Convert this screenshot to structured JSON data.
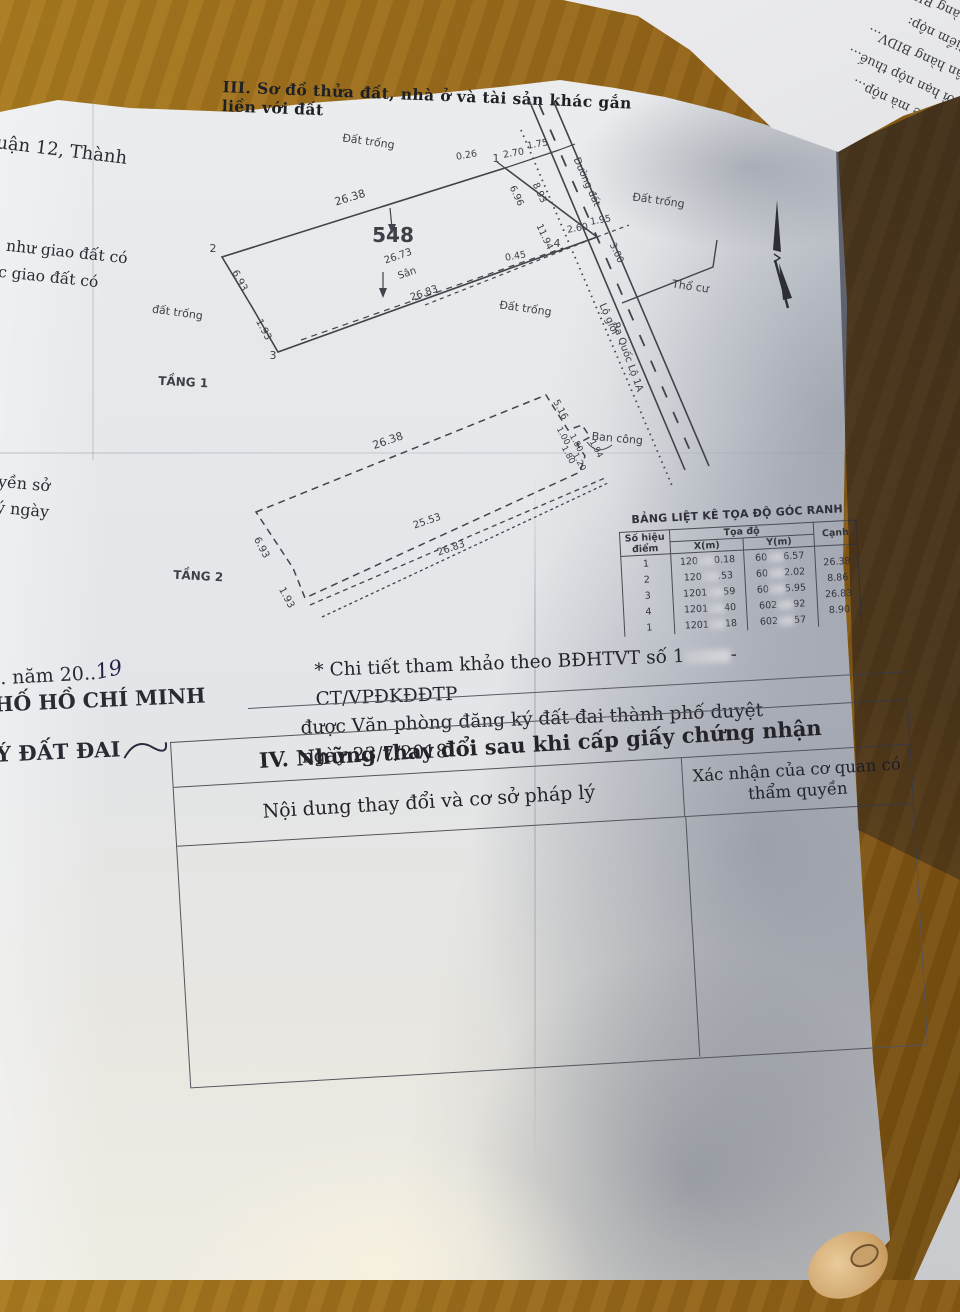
{
  "colors": {
    "wood": "#94661a",
    "paper": "#e6e8ea",
    "ink": "#232329",
    "diagram_ink": "#3e3f47",
    "shadow": "#5a6275"
  },
  "header": {
    "section_title": "III. Sơ đồ thửa đất, nhà ở và tài sản khác gắn liền với đất"
  },
  "left_margin": {
    "f1": "uận 12, Thành",
    "f2": "như giao đất có",
    "f3": "c giao đất có",
    "f4": "yền sở",
    "f5": "ý ngày",
    "f6a": ". năm 20..",
    "f6_handwritten": "19",
    "f7": "HỐ HỒ CHÍ MINH",
    "f8": "Ý ĐẤT ĐAI"
  },
  "diagram": {
    "parcel_number": "548",
    "labels": [
      {
        "t": "Đất trống",
        "x": 243,
        "y": 45,
        "r": 8,
        "s": 11
      },
      {
        "t": "Đất trống",
        "x": 533,
        "y": 104,
        "r": 8,
        "s": 11
      },
      {
        "t": "Đất trống",
        "x": 400,
        "y": 212,
        "r": 8,
        "s": 11
      },
      {
        "t": "đất trống",
        "x": 52,
        "y": 216,
        "r": 8,
        "s": 11
      },
      {
        "t": "Thổ cư",
        "x": 565,
        "y": 190,
        "r": 8,
        "s": 11
      },
      {
        "t": "TẦNG 1",
        "x": 58,
        "y": 286,
        "r": 3,
        "s": 12,
        "b": 1
      },
      {
        "t": "TẦNG 2",
        "x": 73,
        "y": 480,
        "r": 3,
        "s": 12,
        "b": 1
      },
      {
        "t": "548",
        "x": 268,
        "y": 142,
        "r": 0,
        "s": 20,
        "b": 1
      },
      {
        "t": "26.38",
        "x": 226,
        "y": 101,
        "r": -17,
        "s": 11
      },
      {
        "t": "26.73",
        "x": 274,
        "y": 159,
        "r": -19,
        "s": 10
      },
      {
        "t": "Sân",
        "x": 283,
        "y": 176,
        "r": -19,
        "s": 10
      },
      {
        "t": "26.83",
        "x": 300,
        "y": 196,
        "r": -19,
        "s": 10
      },
      {
        "t": "6.93",
        "x": 112,
        "y": 182,
        "r": 62,
        "s": 10
      },
      {
        "t": "1.93",
        "x": 136,
        "y": 231,
        "r": 62,
        "s": 10
      },
      {
        "t": "2",
        "x": 88,
        "y": 152,
        "r": 0,
        "s": 11
      },
      {
        "t": "3",
        "x": 148,
        "y": 259,
        "r": 0,
        "s": 11
      },
      {
        "t": "1",
        "x": 371,
        "y": 62,
        "r": 0,
        "s": 11
      },
      {
        "t": "4",
        "x": 432,
        "y": 147,
        "r": 0,
        "s": 11
      },
      {
        "t": "0.26",
        "x": 342,
        "y": 58,
        "r": -10,
        "s": 9.5
      },
      {
        "t": "2.70",
        "x": 389,
        "y": 56,
        "r": -10,
        "s": 9.5
      },
      {
        "t": "1.75",
        "x": 413,
        "y": 47,
        "r": -10,
        "s": 9.5
      },
      {
        "t": "6.96",
        "x": 389,
        "y": 97,
        "r": 65,
        "s": 9.5
      },
      {
        "t": "8.93",
        "x": 412,
        "y": 94,
        "r": 65,
        "s": 9.5
      },
      {
        "t": "11.94",
        "x": 417,
        "y": 138,
        "r": 65,
        "s": 9.5
      },
      {
        "t": "2.60",
        "x": 453,
        "y": 131,
        "r": -10,
        "s": 9.5
      },
      {
        "t": "1.95",
        "x": 476,
        "y": 123,
        "r": -10,
        "s": 9.5
      },
      {
        "t": "3.00",
        "x": 489,
        "y": 154,
        "r": 65,
        "s": 9.5
      },
      {
        "t": "0.45",
        "x": 391,
        "y": 159,
        "r": -10,
        "s": 9.5
      },
      {
        "t": "Đường đất",
        "x": 459,
        "y": 83,
        "r": 66,
        "s": 10
      },
      {
        "t": "Lộ giới",
        "x": 481,
        "y": 220,
        "r": 66,
        "s": 10
      },
      {
        "t": "Ra Quốc Lộ 1A",
        "x": 500,
        "y": 258,
        "r": 70,
        "s": 10
      },
      {
        "t": "Ban công",
        "x": 492,
        "y": 342,
        "r": 5,
        "s": 11
      },
      {
        "t": "26.38",
        "x": 264,
        "y": 344,
        "r": -19,
        "s": 11
      },
      {
        "t": "25.53",
        "x": 303,
        "y": 424,
        "r": -19,
        "s": 10
      },
      {
        "t": "26.83",
        "x": 327,
        "y": 451,
        "r": -19,
        "s": 10
      },
      {
        "t": "6.93",
        "x": 134,
        "y": 449,
        "r": 62,
        "s": 10
      },
      {
        "t": "1.93",
        "x": 159,
        "y": 499,
        "r": 62,
        "s": 10
      },
      {
        "t": "5.16",
        "x": 433,
        "y": 311,
        "r": 62,
        "s": 9.5
      },
      {
        "t": "1.00",
        "x": 436,
        "y": 337,
        "r": 62,
        "s": 8.5
      },
      {
        "t": "1.80",
        "x": 449,
        "y": 344,
        "r": 62,
        "s": 8.5
      },
      {
        "t": "1.80",
        "x": 441,
        "y": 356,
        "r": 62,
        "s": 8.5
      },
      {
        "t": "1.20",
        "x": 452,
        "y": 363,
        "r": 62,
        "s": 8.5
      },
      {
        "t": "1.94",
        "x": 469,
        "y": 350,
        "r": 62,
        "s": 8.5
      }
    ]
  },
  "coord_table": {
    "title": "BẢNG LIỆT KÊ TỌA ĐỘ GÓC RANH",
    "col_point": "Số hiệu điểm",
    "col_coord": "Tọa độ",
    "col_x": "X(m)",
    "col_y": "Y(m)",
    "col_edge": "Cạnh",
    "rows": [
      {
        "p": "1",
        "x1": "120",
        "x2": "0.18",
        "y1": "60",
        "y2": "6.57",
        "e": "26.38"
      },
      {
        "p": "2",
        "x1": "120",
        "x2": ".53",
        "y1": "60",
        "y2": "2.02",
        "e": "8.86"
      },
      {
        "p": "3",
        "x1": "1201",
        "x2": "59",
        "y1": "60",
        "y2": "5.95",
        "e": "26.83"
      },
      {
        "p": "4",
        "x1": "1201",
        "x2": "40",
        "y1": "602",
        "y2": "92",
        "e": "8.90"
      },
      {
        "p": "1",
        "x1": "1201",
        "x2": "18",
        "y1": "602",
        "y2": "57",
        "e": ""
      }
    ]
  },
  "note": {
    "l1a": "* Chi tiết tham khảo theo BĐHTVT số 1",
    "l1b": "-CT/VPĐKĐĐTP",
    "l2": "được Văn phòng đăng ký đất đai thành phố duyệt ngày 23/7/2018"
  },
  "section4": {
    "title": "IV. Những thay đổi sau khi cấp giấy chứng nhận",
    "col_left": "Nội dung thay đổi và cơ sở pháp lý",
    "col_right": "Xác nhận của cơ quan có thẩm quyền"
  },
  "fold": {
    "lines": [
      "10/10/…  Nế… 03…",
      "nhà ở thuế…",
      "5. Trường…",
      "quản lý thuế",
      "quan thuế mà nộp…",
      "4. Thời hạn nộp thuế…",
      "1. Ngân hàng BIDV…",
      "1. Địa điểm nộp:",
      "2. Ngân hàng BIDV Ch…",
      "Nộp theo chương 757 loại…",
      "…đồng chức: Không đồng…"
    ]
  }
}
